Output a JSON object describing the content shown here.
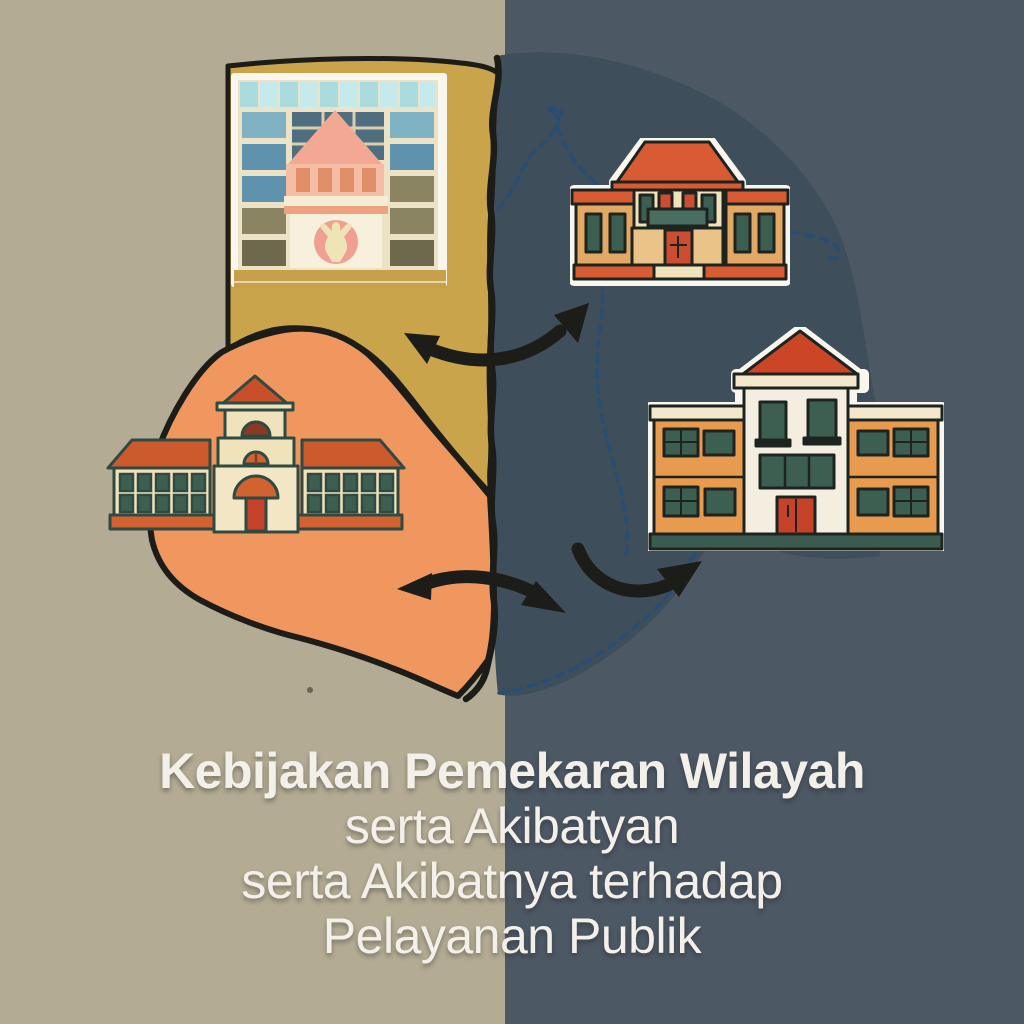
{
  "title": {
    "lines": [
      "Kebijakan Pemekaran Wilayah",
      "serta Akibatyan",
      "serta Akibatnya terhadap",
      "Pelayanan Publik"
    ],
    "color": "#f3f0ea"
  },
  "scene": {
    "background": {
      "left_color": "#b3ab93",
      "right_color": "#4d5865"
    },
    "map": {
      "regions": [
        {
          "id": "origin-region-yellow",
          "color": "#c9a44a"
        },
        {
          "id": "origin-region-orange",
          "color": "#f0975f"
        },
        {
          "id": "expansion-region-blue",
          "color": "#3f4e5b"
        }
      ],
      "solid_border_color": "#1c1c18",
      "dashed_border_color": "#2a4d74"
    },
    "arrows": {
      "color": "#1a1a16",
      "items": [
        "split-arrow-top",
        "split-arrow-bottom",
        "flow-arrow-right"
      ]
    },
    "buildings": [
      {
        "id": "highrise-office-sticker",
        "position": "top-left"
      },
      {
        "id": "district-office-sticker",
        "position": "top-right"
      },
      {
        "id": "school-building",
        "position": "middle-left"
      },
      {
        "id": "public-service-office-sticker",
        "position": "middle-right"
      }
    ]
  },
  "palette": {
    "bg-left": "#b3ab93",
    "bg-right": "#4d5865",
    "map-blue": "#3f4e5b",
    "map-yellow": "#c9a44a",
    "map-orange": "#f0975f",
    "ink": "#1c1c18",
    "navy": "#2a4d74",
    "sticker-white": "#f9f6ee",
    "title-color": "#f3f0ea",
    "roof-red": "#cd4527",
    "roof-orange": "#d95b33",
    "roof-brick": "#cc5a2d",
    "wall-amber": "#e3a964",
    "wall-tan": "#e9c387",
    "wall-orange": "#e89a4e",
    "cream": "#f0e2ba",
    "cream-2": "#f2e6c4",
    "cream-light": "#f4eee0",
    "cream-band": "#f3e8cc",
    "facade-cream": "#ece3c6",
    "green-window": "#3d5f52",
    "teal-sign": "#4a6d62",
    "door-red": "#c5432a",
    "door-red-2": "#cc4e2e",
    "dark-outline": "#1d2420",
    "teal-outline": "#2e4a42",
    "base-green": "#3b5a50",
    "pink-roof": "#f2a893",
    "pink-wall": "#f6bda6",
    "pink-panel": "#e08f66",
    "pink-emblem": "#f0a090",
    "emblem-figure": "#efe3b8",
    "cyan-band": "#a9dbdf",
    "cyan-band-2": "#c5eaec",
    "mustard": "#c8a04a",
    "win-blue-1": "#7fb3c4",
    "win-blue-2": "#5f92ac",
    "win-olive": "#8a8462",
    "win-olive-2": "#6e684c",
    "glass-dark": "#4f6f80",
    "arch-dark": "#8a3a24",
    "arch-orange": "#d2622f"
  }
}
